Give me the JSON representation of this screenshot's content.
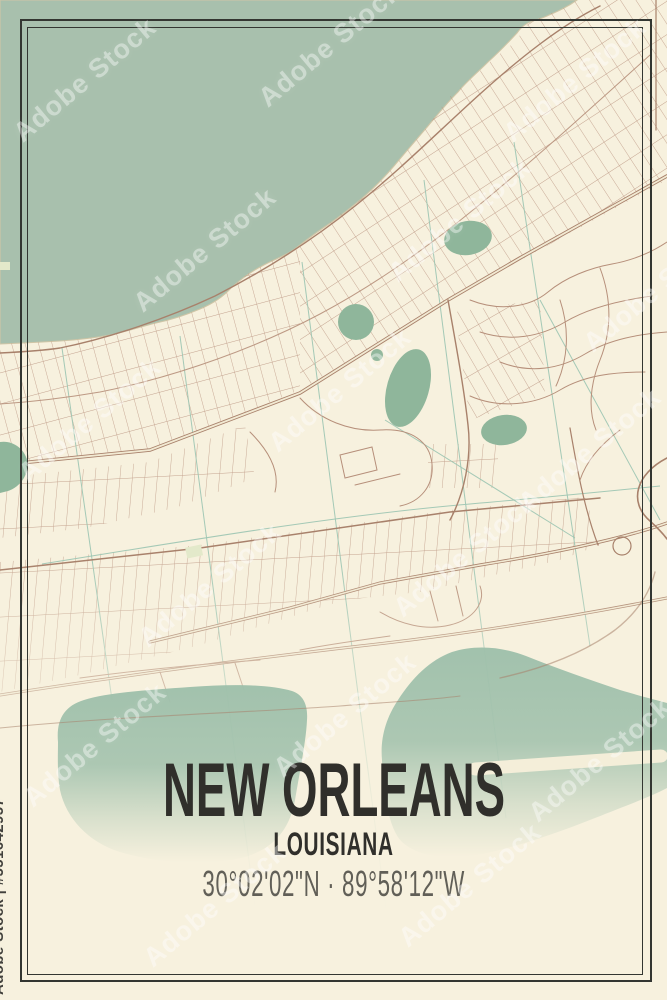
{
  "poster": {
    "title": "NEW ORLEANS",
    "subtitle": "LOUISIANA",
    "coordinates": "30°02'02\"N · 89°58'12\"W"
  },
  "watermark": {
    "text": "Adobe Stock",
    "credit": "Adobe Stock | #551642957"
  },
  "colors": {
    "land": "#f7f1de",
    "water": "#a8c0ad",
    "pond": "#8fb69b",
    "lake": "#9fc0ab",
    "road": "#b68f7a",
    "road-dark": "#a8816b",
    "road-fill": "#f2ead3",
    "canal": "#9fc6b3",
    "park": "#e3e9ca",
    "frame": "#333631",
    "ink": "#302f2b",
    "coord": "#615f57",
    "runway": "#f4eed9"
  }
}
